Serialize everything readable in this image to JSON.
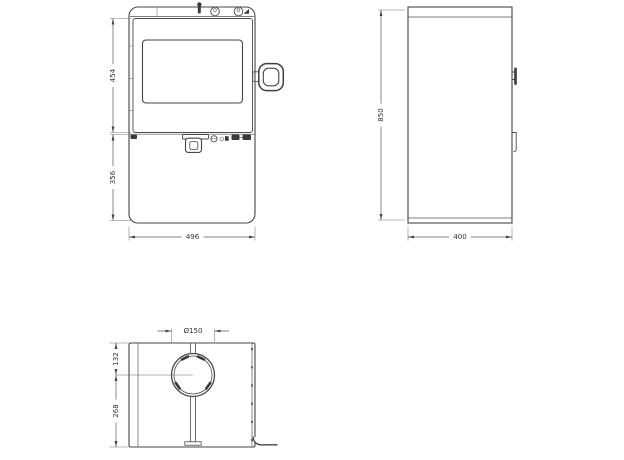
{
  "front_view": {
    "dim_door_height": "454",
    "dim_base_height": "356",
    "dim_width": "496"
  },
  "side_view": {
    "dim_height": "850",
    "dim_depth": "400"
  },
  "top_view": {
    "dim_flue_diameter": "Ø150",
    "dim_flue_center_from_back": "132",
    "dim_flue_center_to_front": "268"
  }
}
